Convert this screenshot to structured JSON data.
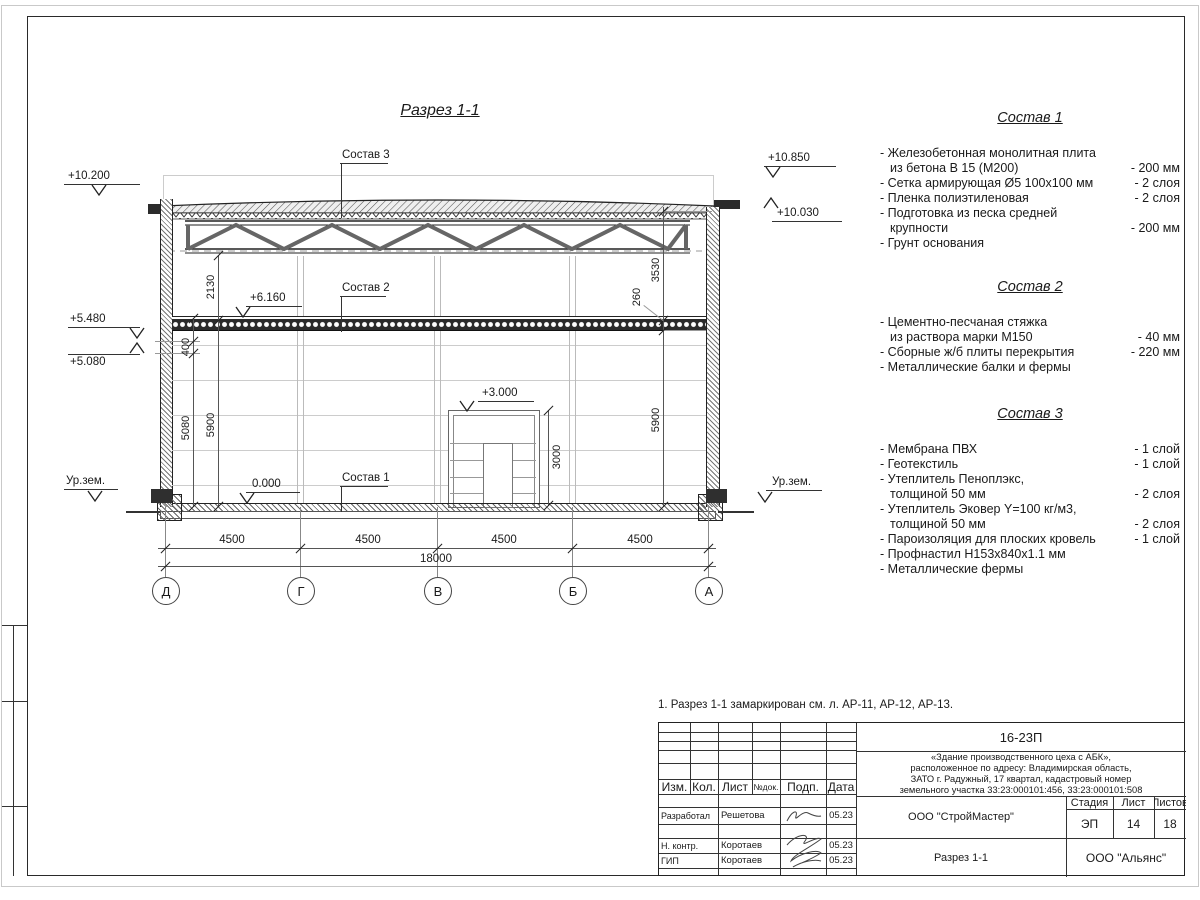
{
  "sheet": {
    "title": "Разрез 1-1",
    "note": "1. Разрез 1-1 замаркирован см. л. АР-11, АР-12, АР-13."
  },
  "drawing": {
    "leaders": {
      "sostav1": "Состав 1",
      "sostav2": "Состав 2",
      "sostav3": "Состав 3"
    },
    "elevations": {
      "left_top": "+10.200",
      "left_upper": "+5.480",
      "left_lower": "+5.080",
      "right_top": "+10.850",
      "right_parapet": "+10.030",
      "floor2": "+6.160",
      "mezzanine": "+3.000",
      "zero": "0.000",
      "ground_left": "Ур.зем.",
      "ground_right": "Ур.зем."
    },
    "dims": {
      "v2130": "2130",
      "v400": "400",
      "v5080": "5080",
      "v5900_left": "5900",
      "v3530": "3530",
      "v260": "260",
      "v5900_right": "5900",
      "v3000": "3000",
      "spans": [
        "4500",
        "4500",
        "4500",
        "4500"
      ],
      "total": "18000"
    },
    "axes": [
      "Д",
      "Г",
      "В",
      "Б",
      "А"
    ]
  },
  "compositions": [
    {
      "title": "Состав 1",
      "items": [
        {
          "name": "- Железобетонная  монолитная плита\nиз бетона В 15 (М200)",
          "value": "- 200 мм"
        },
        {
          "name": "- Сетка армирующая Ø5 100х100 мм",
          "value": "- 2 слоя"
        },
        {
          "name": "- Пленка полиэтиленовая",
          "value": "- 2 слоя"
        },
        {
          "name": "- Подготовка из песка средней\nкрупности",
          "value": "- 200 мм"
        },
        {
          "name": "- Грунт основания",
          "value": ""
        }
      ]
    },
    {
      "title": "Состав 2",
      "items": [
        {
          "name": "- Цементно-песчаная стяжка\nиз раствора марки М150",
          "value": "- 40 мм"
        },
        {
          "name": "- Сборные ж/б плиты перекрытия",
          "value": "- 220 мм"
        },
        {
          "name": "- Металлические балки и фермы",
          "value": ""
        }
      ]
    },
    {
      "title": "Состав 3",
      "items": [
        {
          "name": "- Мембрана ПВХ",
          "value": "- 1 слой"
        },
        {
          "name": "- Геотекстиль",
          "value": "- 1 слой"
        },
        {
          "name": "- Утеплитель Пеноплэкс,\nтолщиной 50 мм",
          "value": "- 2 слоя"
        },
        {
          "name": "- Утеплитель Эковер Y=100 кг/м3,\nтолщиной 50 мм",
          "value": "- 2 слоя"
        },
        {
          "name": "- Пароизоляция для плоских кровель",
          "value": "- 1 слой"
        },
        {
          "name": "- Профнастил Н153х840х1.1 мм",
          "value": ""
        },
        {
          "name": "- Металлические фермы",
          "value": ""
        }
      ]
    }
  ],
  "titleblock": {
    "doc_number": "16-23П",
    "object_description": "«Здание производственного цеха с АБК»,\nрасположенное по адресу: Владимирская область,\nЗАТО г. Радужный, 17 квартал, кадастровый номер\nземельного участка 33:23:000101:456, 33:23:000101:508",
    "columns": {
      "izm": "Изм.",
      "kol": "Кол.",
      "list": "Лист",
      "ndok": "№док.",
      "podp": "Подп.",
      "data": "Дата"
    },
    "rows": [
      {
        "role": "Разработал",
        "name": "Решетова",
        "date": "05.23"
      },
      {
        "role": "Н. контр.",
        "name": "Коротаев",
        "date": "05.23"
      },
      {
        "role": "ГИП",
        "name": "Коротаев",
        "date": "05.23"
      }
    ],
    "org_row": "ООО \"СтройМастер\"",
    "stage_label": "Стадия",
    "sheet_label": "Лист",
    "sheets_label": "Листов",
    "stage": "ЭП",
    "sheet_no": "14",
    "sheets_total": "18",
    "drawing_name": "Разрез 1-1",
    "company": "ООО \"Альянс\""
  }
}
